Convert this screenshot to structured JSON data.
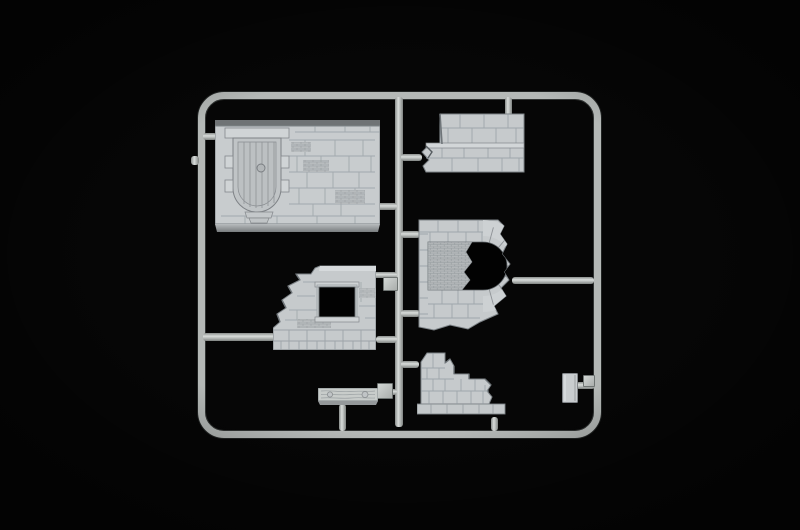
{
  "scene": {
    "subject": "Injection-molded plastic model sprue with stone wall diorama parts on a black background",
    "background_color": "#060606",
    "runner_color": "#b4b8b6",
    "plastic_color": "#c7cbcd",
    "engraving_color": "#8d9399",
    "part_count": "7"
  },
  "parts": [
    {
      "label": "Wall section with arched plank door"
    },
    {
      "label": "Ruined corner wall section of large stone blocks"
    },
    {
      "label": "Wall section with partly bricked-up arch opening"
    },
    {
      "label": "Ruined wall section with square window"
    },
    {
      "label": "Wooden plank base piece"
    },
    {
      "label": "Broken stepped wall fragment"
    },
    {
      "label": "Small flat slab piece"
    }
  ],
  "frame": {
    "label": "Rounded rectangular sprue frame with central runner"
  }
}
